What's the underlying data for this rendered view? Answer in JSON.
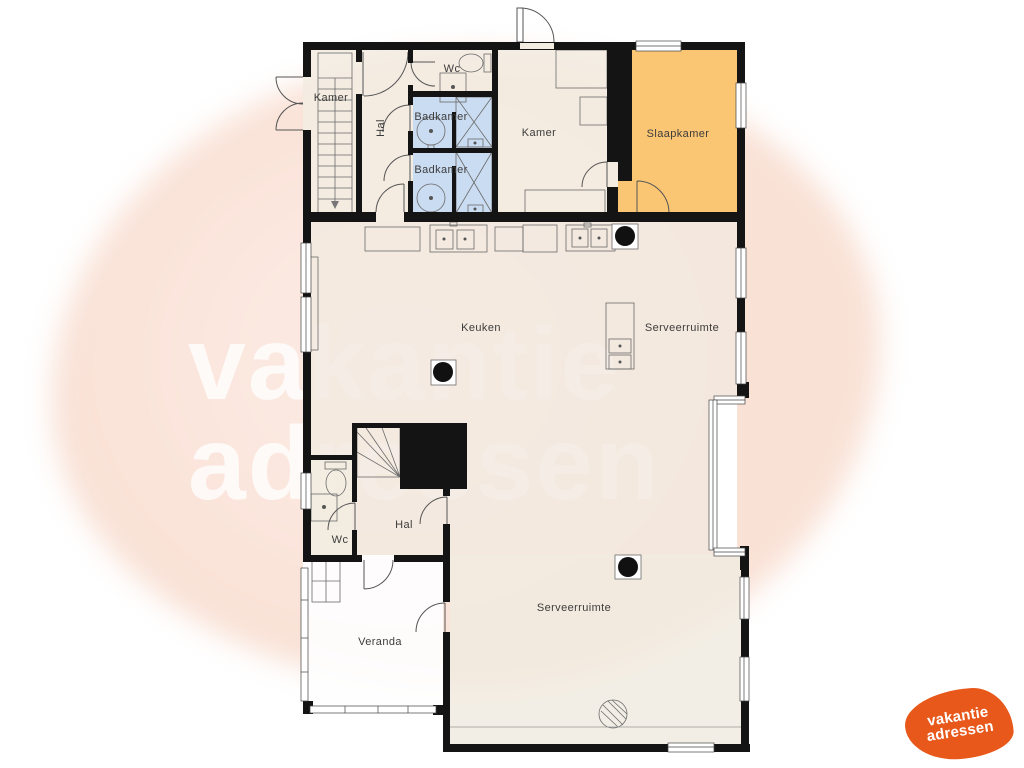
{
  "watermark": {
    "line1": "vakantie",
    "line2": "adressen"
  },
  "logo": {
    "line1": "vakantie",
    "line2": "adressen"
  },
  "floor_plan": {
    "rooms": {
      "kamer_top_left": "Kamer",
      "hal_upper": "Hal",
      "wc_upper": "Wc",
      "badkamer_1": "Badkamer",
      "badkamer_2": "Badkamer",
      "kamer_middle": "Kamer",
      "slaapkamer": "Slaapkamer",
      "keuken": "Keuken",
      "serveerruimte_upper": "Serveerruimte",
      "wc_lower": "Wc",
      "hal_lower": "Hal",
      "veranda": "Veranda",
      "serveerruimte_lower": "Serveerruimte"
    },
    "colors": {
      "slaapkamer": "#FAC46F",
      "badkamer": "#C8DBF1",
      "floor": "#F2EAE0",
      "floor_top": "#F3ECE1",
      "wall": "#141414",
      "watermark_blob": "#FBE5DC",
      "logo_orange": "#E8581B"
    }
  }
}
